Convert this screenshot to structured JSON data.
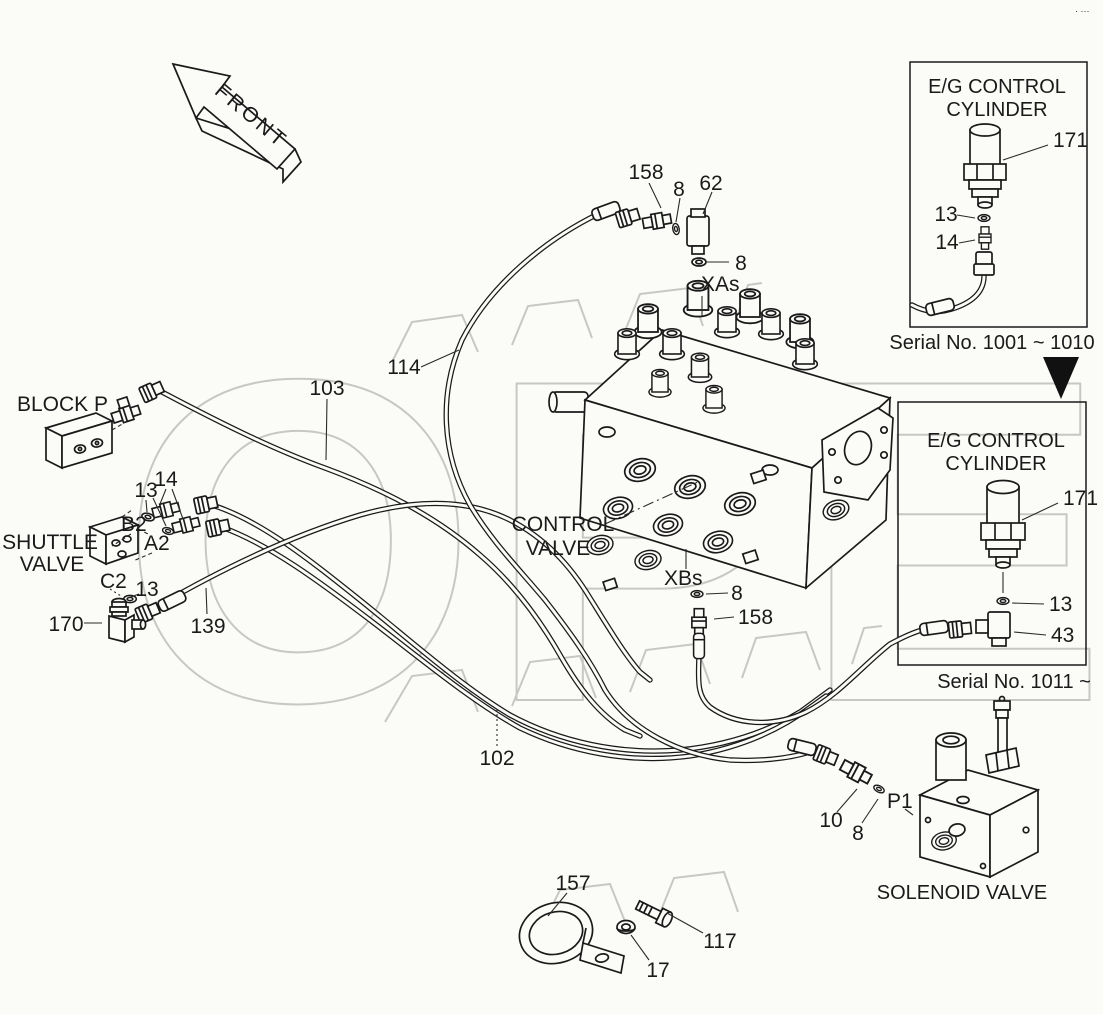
{
  "page": {
    "corner_mark": "· ···"
  },
  "front_arrow": {
    "label": "FRONT"
  },
  "inset_top": {
    "title1": "E/G CONTROL",
    "title2": "CYLINDER",
    "caption": "Serial No. 1001 ~ 1010",
    "callout_171": "171",
    "callout_13": "13",
    "callout_14": "14"
  },
  "inset_bottom": {
    "title1": "E/G CONTROL",
    "title2": "CYLINDER",
    "caption": "Serial No. 1011 ~",
    "callout_171": "171",
    "callout_13": "13",
    "callout_43": "43"
  },
  "components": {
    "block_p": "BLOCK P",
    "shuttle1": "SHUTTLE",
    "shuttle2": "VALVE",
    "control1": "CONTROL",
    "control2": "VALVE",
    "solenoid": "SOLENOID VALVE"
  },
  "ports": {
    "xas": "XAs",
    "xbs": "XBs",
    "b2": "B2",
    "a2": "A2",
    "c2": "C2",
    "p1": "P1"
  },
  "callouts": {
    "c158_top": "158",
    "c8_top": "8",
    "c62": "62",
    "c8_xas": "8",
    "c114": "114",
    "c103": "103",
    "c102": "102",
    "c139": "139",
    "c13_left": "13",
    "c14_left": "14",
    "c13_c2": "13",
    "c170": "170",
    "c8_xbs": "8",
    "c158_xbs": "158",
    "c10": "10",
    "c8_p1": "8",
    "c157": "157",
    "c17": "17",
    "c117": "117"
  }
}
